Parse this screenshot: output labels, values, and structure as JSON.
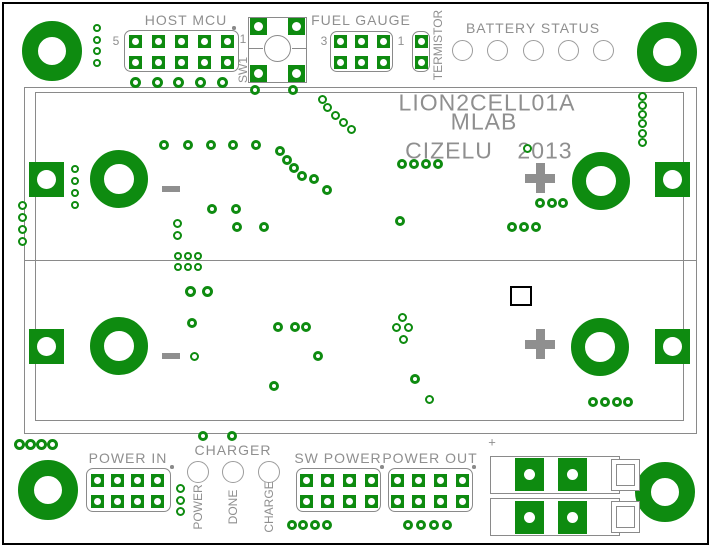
{
  "colors": {
    "copper_green": "#0e8b10",
    "silkscreen_gray": "#8f8f8f",
    "outline_gray": "#8a8a8a",
    "led_ring_gray": "#9c9c9c",
    "background": "#ffffff",
    "frame_black": "#000000"
  },
  "silkscreen": {
    "board_name": "LION2CELL01A",
    "org": "MLAB",
    "designer": "CIZELU",
    "year": "2013",
    "connector_plus": "+"
  },
  "headers": [
    {
      "name": "host-mcu",
      "label": "HOST MCU",
      "left_pin_label": "5",
      "right_pin_label": "1",
      "cols": 5,
      "rows": 2,
      "first_pad": [
        135,
        41
      ],
      "pitch": [
        23,
        21
      ],
      "pad_size": 13,
      "hole": 7,
      "outline": [
        124,
        30,
        115,
        42
      ],
      "label_pos": [
        186,
        20
      ],
      "left_pin_pos": [
        116,
        41
      ],
      "right_pin_pos": [
        243,
        39
      ],
      "pin1_dot": [
        234,
        28
      ]
    },
    {
      "name": "fuel-gauge",
      "label": "FUEL GAUGE",
      "left_pin_label": "3",
      "right_pin_label": "1",
      "cols": 3,
      "rows": 2,
      "first_pad": [
        340,
        41
      ],
      "pitch": [
        21.5,
        21
      ],
      "pad_size": 13,
      "hole": 7,
      "outline": [
        330,
        31,
        63,
        41
      ],
      "label_pos": [
        361,
        20
      ],
      "left_pin_pos": [
        324,
        41
      ],
      "right_pin_pos": [
        401,
        41
      ]
    },
    {
      "name": "termistor",
      "label": "TERMISTOR",
      "cols": 1,
      "rows": 2,
      "first_pad": [
        421,
        41
      ],
      "pitch": [
        0,
        21
      ],
      "pad_size": 13,
      "hole": 7,
      "outline": [
        412,
        31,
        18,
        41
      ],
      "label_pos": [
        438,
        45
      ],
      "label_vertical": true
    },
    {
      "name": "power-in",
      "label": "POWER IN",
      "cols": 4,
      "rows": 2,
      "first_pad": [
        97,
        480
      ],
      "pitch": [
        20,
        21
      ],
      "pad_size": 13,
      "hole": 7,
      "outline": [
        86,
        468,
        85,
        44
      ],
      "label_pos": [
        128,
        458
      ],
      "pin1_dot": [
        172,
        467
      ]
    },
    {
      "name": "sw-power",
      "label": "SW POWER",
      "cols": 4,
      "rows": 2,
      "first_pad": [
        306,
        480
      ],
      "pitch": [
        21.7,
        21
      ],
      "pad_size": 13,
      "hole": 7,
      "outline": [
        296,
        468,
        85,
        44
      ],
      "label_pos": [
        338,
        458
      ],
      "pin1_dot": [
        382,
        467
      ]
    },
    {
      "name": "power-out",
      "label": "POWER OUT",
      "cols": 4,
      "rows": 2,
      "first_pad": [
        397,
        480
      ],
      "pitch": [
        21.7,
        21
      ],
      "pad_size": 13,
      "hole": 7,
      "outline": [
        388,
        468,
        85,
        44
      ],
      "label_pos": [
        430,
        458
      ],
      "pin1_dot": [
        474,
        467
      ]
    }
  ],
  "tactile_switch": {
    "name": "sw1",
    "label": "SW1",
    "outline": [
      248,
      17,
      59,
      66
    ],
    "button": [
      277,
      48,
      27
    ],
    "pads": [
      [
        258,
        26
      ],
      [
        296,
        26
      ],
      [
        258,
        73
      ],
      [
        296,
        73
      ]
    ],
    "pad_size": 17,
    "hole": 9,
    "label_pos": [
      243,
      70
    ],
    "lines": [
      [
        248,
        48,
        15
      ],
      [
        292,
        48,
        15
      ]
    ]
  },
  "led_groups": [
    {
      "name": "battery-status",
      "label": "BATTERY STATUS",
      "label_pos": [
        533,
        28
      ],
      "diameter": 21,
      "leds": [
        [
          462,
          50
        ],
        [
          497,
          50
        ],
        [
          533,
          50
        ],
        [
          568,
          50
        ],
        [
          603,
          50
        ]
      ]
    },
    {
      "name": "charger",
      "label": "CHARGER",
      "label_pos": [
        233,
        450
      ],
      "diameter": 22,
      "leds": [
        [
          198,
          472
        ],
        [
          233,
          472
        ],
        [
          269,
          472
        ]
      ],
      "led_labels": [
        "POWER",
        "DONE",
        "CHARGE"
      ],
      "led_label_y": 507
    }
  ],
  "holder_outline": {
    "outer": [
      24,
      87,
      673,
      347
    ],
    "inner": [
      35,
      92,
      649,
      329
    ],
    "divider_y": 260
  },
  "mount_holes": [
    [
      52,
      51
    ],
    [
      667,
      52
    ],
    [
      48,
      490
    ],
    [
      665,
      492
    ]
  ],
  "mount_hole_size": [
    60,
    28
  ],
  "cell_contacts": {
    "annuli": [
      [
        119,
        179
      ],
      [
        601,
        181
      ],
      [
        119,
        346
      ],
      [
        600,
        347
      ]
    ],
    "annulus_size": [
      58,
      29
    ],
    "squares": [
      [
        29,
        162
      ],
      [
        655,
        162
      ],
      [
        29,
        329
      ],
      [
        655,
        329
      ]
    ],
    "square_size": 35,
    "square_hole": 19,
    "polarity": [
      {
        "symbol": "-",
        "pos": [
          171,
          189
        ]
      },
      {
        "symbol": "+",
        "pos": [
          540,
          178
        ]
      },
      {
        "symbol": "-",
        "pos": [
          171,
          356
        ]
      },
      {
        "symbol": "+",
        "pos": [
          540,
          344
        ]
      }
    ]
  },
  "smd_part": [
    510,
    286,
    22,
    20
  ],
  "connector": {
    "name": "battery-connector",
    "plus_pos": [
      492,
      442
    ],
    "rows": [
      {
        "outline": [
          490,
          456,
          130,
          38
        ],
        "pads": [
          [
            515,
            458
          ],
          [
            558,
            458
          ]
        ],
        "end_box": [
          611,
          459,
          29,
          32
        ],
        "end_box_inner": [
          616,
          464,
          19,
          22
        ]
      },
      {
        "outline": [
          490,
          498,
          130,
          38
        ],
        "pads": [
          [
            515,
            501
          ],
          [
            558,
            501
          ]
        ],
        "end_box": [
          611,
          501,
          29,
          32
        ],
        "end_box_inner": [
          616,
          506,
          19,
          22
        ]
      }
    ],
    "pad_size": [
      29,
      33
    ],
    "hole": 11
  },
  "vias": [
    [
      97,
      28,
      8
    ],
    [
      97,
      40,
      8
    ],
    [
      97,
      51,
      8
    ],
    [
      97,
      63,
      8
    ],
    [
      135,
      82,
      11
    ],
    [
      157,
      82,
      11
    ],
    [
      178,
      82,
      11
    ],
    [
      200,
      82,
      11
    ],
    [
      222,
      82,
      11
    ],
    [
      255,
      90,
      10
    ],
    [
      293,
      90,
      10
    ],
    [
      642,
      96,
      9
    ],
    [
      642,
      105,
      9
    ],
    [
      642,
      114,
      9
    ],
    [
      642,
      123,
      9
    ],
    [
      642,
      133,
      9
    ],
    [
      642,
      142,
      9
    ],
    [
      164,
      145,
      10
    ],
    [
      188,
      145,
      10
    ],
    [
      211,
      145,
      10
    ],
    [
      233,
      145,
      10
    ],
    [
      256,
      145,
      10
    ],
    [
      322,
      99,
      9
    ],
    [
      327,
      107,
      9
    ],
    [
      335,
      115,
      9
    ],
    [
      343,
      122,
      9
    ],
    [
      351,
      129,
      9
    ],
    [
      280,
      151,
      10
    ],
    [
      287,
      160,
      10
    ],
    [
      294,
      168,
      10
    ],
    [
      302,
      176,
      10
    ],
    [
      314,
      179,
      10
    ],
    [
      327,
      190,
      10
    ],
    [
      212,
      209,
      10
    ],
    [
      236,
      209,
      10
    ],
    [
      177,
      223,
      9
    ],
    [
      177,
      235,
      9
    ],
    [
      237,
      227,
      10
    ],
    [
      264,
      227,
      10
    ],
    [
      75,
      169,
      8
    ],
    [
      75,
      181,
      8
    ],
    [
      75,
      193,
      8
    ],
    [
      75,
      205,
      8
    ],
    [
      22,
      205,
      9
    ],
    [
      22,
      217,
      9
    ],
    [
      22,
      229,
      9
    ],
    [
      22,
      241,
      9
    ],
    [
      402,
      164,
      10
    ],
    [
      414,
      164,
      10
    ],
    [
      426,
      164,
      10
    ],
    [
      438,
      164,
      10
    ],
    [
      400,
      221,
      10
    ],
    [
      527,
      148,
      9
    ],
    [
      540,
      203,
      10
    ],
    [
      552,
      203,
      10
    ],
    [
      563,
      203,
      10
    ],
    [
      512,
      227,
      10
    ],
    [
      524,
      227,
      10
    ],
    [
      536,
      227,
      10
    ],
    [
      178,
      256,
      8
    ],
    [
      188,
      256,
      8
    ],
    [
      198,
      256,
      8
    ],
    [
      178,
      267,
      8
    ],
    [
      188,
      267,
      8
    ],
    [
      198,
      267,
      8
    ],
    [
      190,
      291,
      11
    ],
    [
      207,
      291,
      11
    ],
    [
      192,
      323,
      10
    ],
    [
      194,
      356,
      9
    ],
    [
      278,
      327,
      10
    ],
    [
      295,
      327,
      10
    ],
    [
      306,
      327,
      10
    ],
    [
      318,
      356,
      10
    ],
    [
      274,
      386,
      10
    ],
    [
      402,
      317,
      9
    ],
    [
      396,
      327,
      9
    ],
    [
      408,
      327,
      9
    ],
    [
      403,
      339,
      9
    ],
    [
      415,
      379,
      10
    ],
    [
      429,
      399,
      9
    ],
    [
      593,
      402,
      10
    ],
    [
      605,
      402,
      10
    ],
    [
      617,
      402,
      10
    ],
    [
      628,
      402,
      10
    ],
    [
      203,
      436,
      10
    ],
    [
      232,
      436,
      10
    ],
    [
      19,
      444,
      11
    ],
    [
      30,
      444,
      11
    ],
    [
      41,
      444,
      11
    ],
    [
      52,
      444,
      11
    ],
    [
      180,
      488,
      9
    ],
    [
      180,
      500,
      9
    ],
    [
      180,
      511,
      9
    ],
    [
      292,
      525,
      10
    ],
    [
      303,
      525,
      10
    ],
    [
      315,
      525,
      10
    ],
    [
      327,
      525,
      10
    ],
    [
      408,
      525,
      10
    ],
    [
      421,
      525,
      10
    ],
    [
      434,
      525,
      10
    ],
    [
      447,
      525,
      10
    ]
  ]
}
